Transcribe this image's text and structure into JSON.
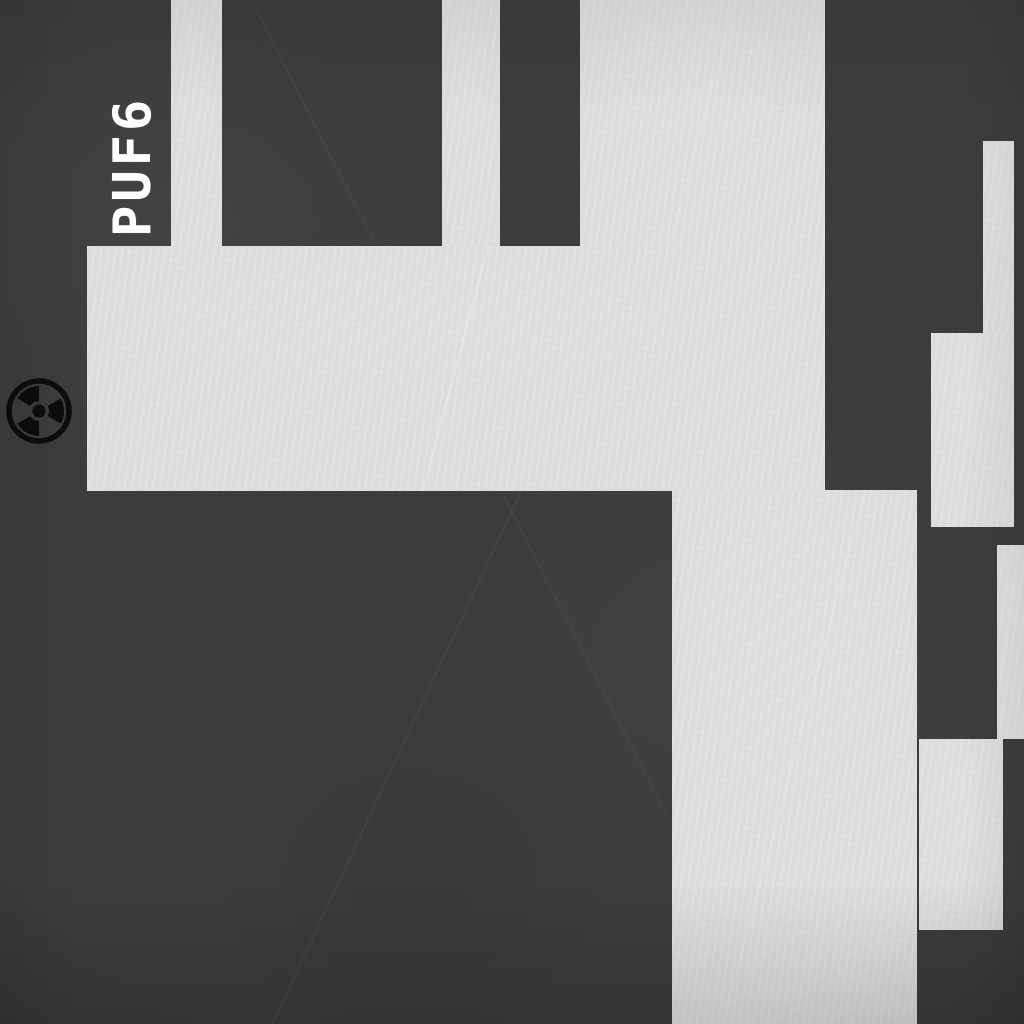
{
  "map": {
    "room_label": "PUF6",
    "hazard_icon": "radiation-icon",
    "colors": {
      "background": "#3b3c3c",
      "floor": "#dfe0e0",
      "label": "#ffffff",
      "hazard": "#0c0c0c"
    },
    "rooms": [
      {
        "id": "corridor-top-a",
        "x": 171,
        "y": 0,
        "w": 51,
        "h": 246
      },
      {
        "id": "corridor-top-b",
        "x": 442,
        "y": 0,
        "w": 58,
        "h": 246
      },
      {
        "id": "room-top",
        "x": 580,
        "y": 0,
        "w": 245,
        "h": 247
      },
      {
        "id": "hall-band",
        "x": 87,
        "y": 246,
        "w": 738,
        "h": 245
      },
      {
        "id": "corridor-main",
        "x": 672,
        "y": 490,
        "w": 245,
        "h": 534
      },
      {
        "id": "nook-right-upper",
        "x": 983,
        "y": 141,
        "w": 31,
        "h": 192
      },
      {
        "id": "room-right-upper",
        "x": 931,
        "y": 333,
        "w": 83,
        "h": 194
      },
      {
        "id": "nook-right-lower",
        "x": 997,
        "y": 545,
        "w": 27,
        "h": 194
      },
      {
        "id": "room-right-lower",
        "x": 919,
        "y": 739,
        "w": 84,
        "h": 191
      }
    ],
    "label_box": {
      "x": 112,
      "y": 237,
      "w": 147,
      "h": 43
    },
    "hazard_box": {
      "x": 6,
      "y": 378,
      "size": 66
    }
  }
}
